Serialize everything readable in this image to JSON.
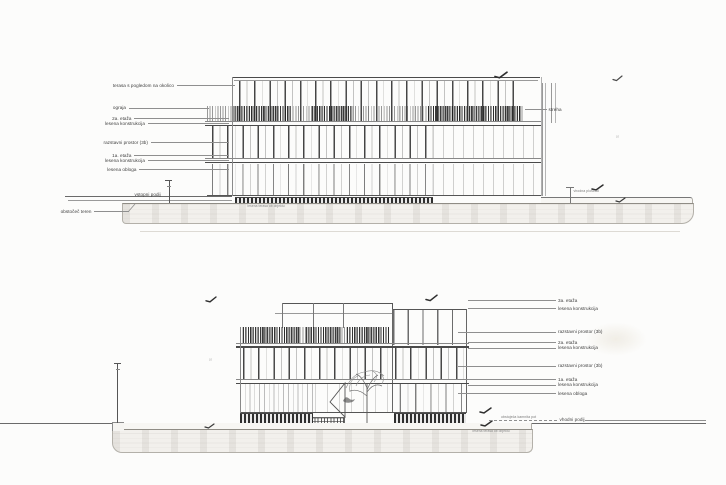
{
  "top_elevation": {
    "labels_left": [
      {
        "text": "terasa s pogledom na okolico"
      },
      {
        "text": "ograja"
      },
      {
        "text": "2a. etaža"
      },
      {
        "text": "lesena konstrukcija"
      },
      {
        "text": "razstavni prostor (3b)"
      },
      {
        "text": "1a. etaža"
      },
      {
        "text": "lesena konstrukcija"
      },
      {
        "text": "lesena obloga"
      }
    ],
    "entry_label": "vstopni podij",
    "terrain_label": "obstočeč teren",
    "roof_label": "streha",
    "plaza_label": "vhodna ploščad",
    "base_note": "lesena terasa ob objektu",
    "level_marker": "S"
  },
  "bottom_elevation": {
    "labels_right": [
      {
        "text": "3a. etaža"
      },
      {
        "text": "lesena konstrukcija"
      },
      {
        "text": "razstavni prostor (3b)"
      },
      {
        "text": "2a. etaža"
      },
      {
        "text": "lesena konstrukcija"
      },
      {
        "text": "razstavni prostor (3b)"
      },
      {
        "text": "1a. etaža"
      },
      {
        "text": "lesena konstrukcija"
      },
      {
        "text": "lesena obloga"
      }
    ],
    "entry_label": "vhodni podij",
    "path_note": "obstoječa kamnita pot",
    "base_note": "lesena terasa ob objektu",
    "level_marker": "S"
  }
}
